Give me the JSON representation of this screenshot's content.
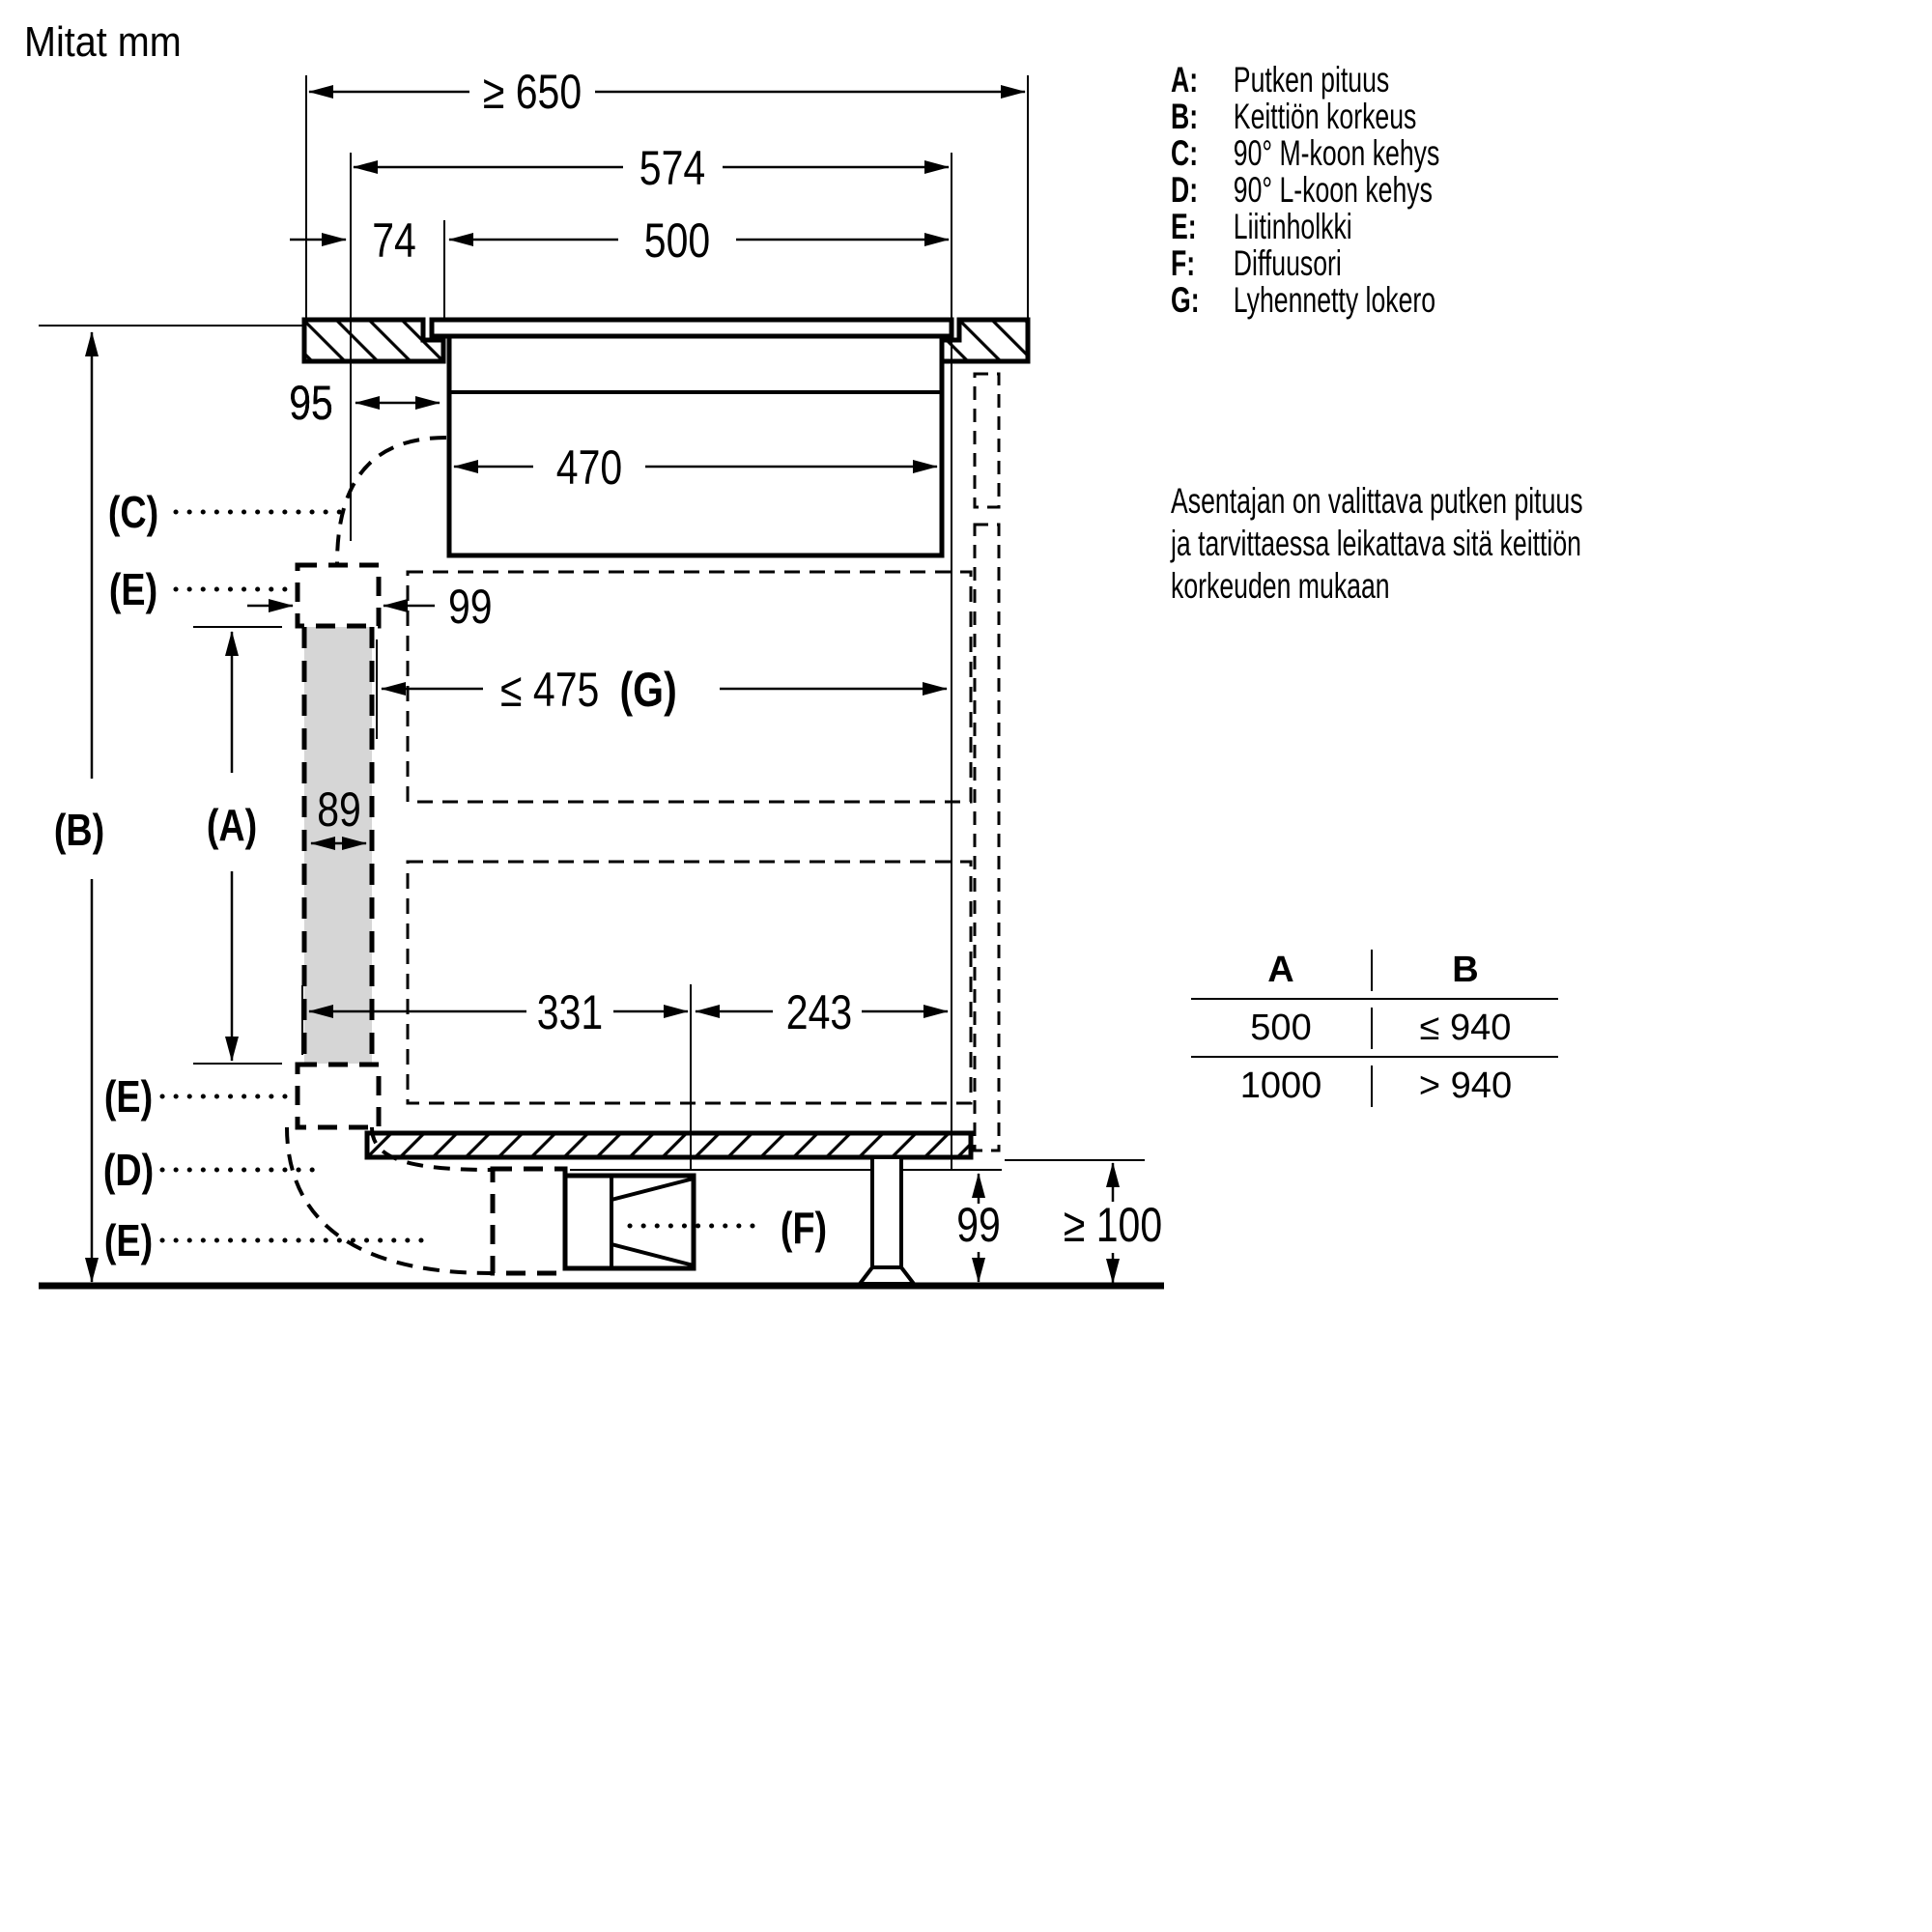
{
  "title": "Mitat mm",
  "diagram": {
    "dimensions": {
      "min_width": "≥ 650",
      "cutout_width": "574",
      "offset_74": "74",
      "inner_cutout_width": "500",
      "clearance_95": "95",
      "body_width": "470",
      "connector_width_99": "99",
      "shortened_compartment": "≤ 475",
      "shortened_compartment_label": "(G)",
      "duct_width_89": "89",
      "dist_331": "331",
      "dist_243": "243",
      "diffuser_height_99": "99",
      "floor_clearance": "≥ 100"
    },
    "callouts": {
      "a": "(A)",
      "b": "(B)",
      "c": "(C)",
      "d": "(D)",
      "e": "(E)",
      "f": "(F)"
    }
  },
  "legend": {
    "items": [
      {
        "key": "A:",
        "label": "Putken pituus"
      },
      {
        "key": "B:",
        "label": "Keittiön korkeus"
      },
      {
        "key": "C:",
        "label": "90° M-koon kehys"
      },
      {
        "key": "D:",
        "label": "90° L-koon kehys"
      },
      {
        "key": "E:",
        "label": "Liitinholkki"
      },
      {
        "key": "F:",
        "label": "Diffuusori"
      },
      {
        "key": "G:",
        "label": "Lyhennetty lokero"
      }
    ]
  },
  "note": {
    "lines": [
      "Asentajan on valittava putken pituus",
      "ja tarvittaessa leikattava sitä keittiön",
      "korkeuden mukaan"
    ]
  },
  "table": {
    "headers": [
      "A",
      "B"
    ],
    "rows": [
      [
        "500",
        "≤ 940"
      ],
      [
        "1000",
        "> 940"
      ]
    ]
  },
  "colors": {
    "line": "#000000",
    "duct_fill": "#d6d6d6",
    "background": "#ffffff"
  }
}
